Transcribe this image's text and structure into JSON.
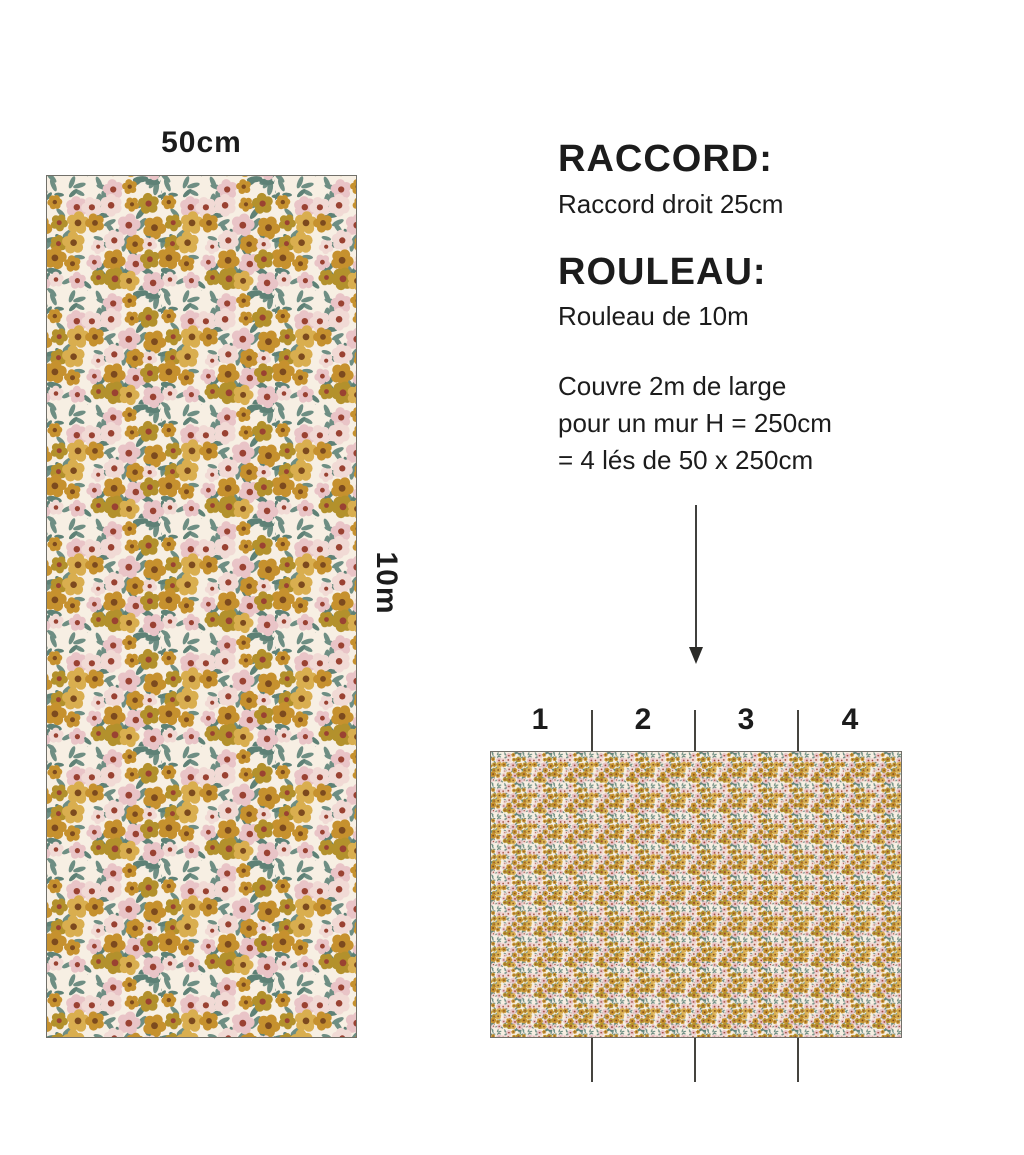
{
  "labels": {
    "roll_width": "50cm",
    "roll_height": "10m"
  },
  "info": {
    "raccord_title": "RACCORD:",
    "raccord_value": "Raccord droit 25cm",
    "rouleau_title": "ROULEAU:",
    "rouleau_value": "Rouleau de 10m",
    "coverage_lines": [
      "Couvre 2m de large",
      "pour un mur H = 250cm",
      "= 4 lés de 50 x 250cm"
    ]
  },
  "wall": {
    "strip_numbers": [
      "1",
      "2",
      "3",
      "4"
    ]
  },
  "palette": {
    "background_cream": "#f7efe3",
    "mustard": "#c6912e",
    "gold_light": "#d9ae4f",
    "olive_gold": "#b3912c",
    "pink": "#e9c4c7",
    "pale_pink": "#f1dad5",
    "leaf_teal": "#6e8e83",
    "leaf_teal_dark": "#5e8176",
    "center_brown": "#7c4a1e",
    "center_red": "#9a4232",
    "border_gray": "#71706a",
    "line_dark": "#45443f",
    "arrow_dark": "#2b2b28",
    "text_black": "#1c1c1c"
  }
}
